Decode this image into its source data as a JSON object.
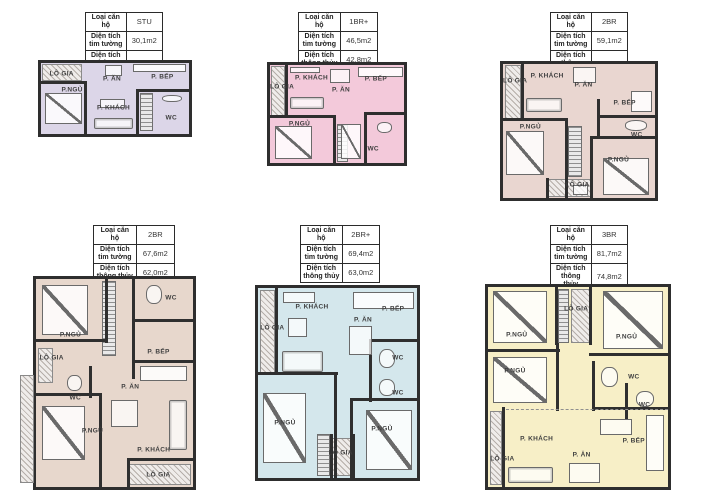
{
  "table_labels": {
    "type": "Loại căn hộ",
    "gross": "Diện tích tim tường",
    "net": "Diện tích thông thủy"
  },
  "units": [
    {
      "type": "STU",
      "gross": "30,1m2",
      "net": "26,3m2",
      "fill": "#dcd6e8",
      "table_box": {
        "left": 85,
        "top": 12,
        "width": 78
      },
      "plan_box": {
        "left": 38,
        "top": 60,
        "width": 154,
        "height": 77
      },
      "labels": [
        {
          "t": "LÔ GIA",
          "x": 14,
          "y": 15
        },
        {
          "t": "P. ĂN",
          "x": 48,
          "y": 22
        },
        {
          "t": "P. BẾP",
          "x": 82,
          "y": 20
        },
        {
          "t": "P.NGỦ",
          "x": 21,
          "y": 38
        },
        {
          "t": "P. KHÁCH",
          "x": 49,
          "y": 64
        },
        {
          "t": "WC",
          "x": 88,
          "y": 77
        }
      ],
      "hatches": [
        {
          "kind": "balcony",
          "x": 1,
          "y": 1,
          "w": 27,
          "h": 24
        },
        {
          "kind": "stairs",
          "x": 67,
          "y": 42,
          "w": 9,
          "h": 54
        }
      ],
      "walls": [
        {
          "x": 0,
          "y": 26,
          "w": 31,
          "h": 4
        },
        {
          "x": 29,
          "y": 26,
          "w": 2.5,
          "h": 74
        },
        {
          "x": 64,
          "y": 36,
          "w": 2.5,
          "h": 64
        },
        {
          "x": 64,
          "y": 36,
          "w": 36,
          "h": 4
        }
      ],
      "items": [
        {
          "kind": "bed",
          "x": 3,
          "y": 42,
          "w": 25,
          "h": 44
        },
        {
          "kind": "sofa",
          "x": 36,
          "y": 78,
          "w": 26,
          "h": 15
        },
        {
          "kind": "table",
          "x": 40,
          "y": 50,
          "w": 17,
          "h": 14
        },
        {
          "kind": "table",
          "x": 43,
          "y": 3,
          "w": 12,
          "h": 15
        },
        {
          "kind": "counter",
          "x": 62,
          "y": 2,
          "w": 36,
          "h": 11
        },
        {
          "kind": "fixture",
          "x": 82,
          "y": 45,
          "w": 13,
          "h": 10
        }
      ]
    },
    {
      "type": "1BR+",
      "gross": "46,5m2",
      "net": "42,8m2",
      "fill": "#f3c9da",
      "table_box": {
        "left": 298,
        "top": 12,
        "width": 80
      },
      "plan_box": {
        "left": 267,
        "top": 62,
        "width": 140,
        "height": 104
      },
      "labels": [
        {
          "t": "P. KHÁCH",
          "x": 31,
          "y": 13
        },
        {
          "t": "P. ĂN",
          "x": 53,
          "y": 25
        },
        {
          "t": "P. BẾP",
          "x": 79,
          "y": 14
        },
        {
          "t": "LÔ GIA",
          "x": 9,
          "y": 22
        },
        {
          "t": "P.NGỦ",
          "x": 22,
          "y": 60
        },
        {
          "t": "WC",
          "x": 77,
          "y": 86
        }
      ],
      "hatches": [
        {
          "kind": "balcony",
          "x": 1,
          "y": 1,
          "w": 10,
          "h": 52
        },
        {
          "kind": "stairs",
          "x": 50,
          "y": 60,
          "w": 8,
          "h": 39
        }
      ],
      "walls": [
        {
          "x": 11,
          "y": 0,
          "w": 2.5,
          "h": 54
        },
        {
          "x": 0,
          "y": 51,
          "w": 49,
          "h": 4
        },
        {
          "x": 47,
          "y": 51,
          "w": 2.5,
          "h": 49
        },
        {
          "x": 70,
          "y": 48,
          "w": 2.5,
          "h": 52
        },
        {
          "x": 70,
          "y": 48,
          "w": 30,
          "h": 4
        }
      ],
      "items": [
        {
          "kind": "table",
          "x": 15,
          "y": 2,
          "w": 22,
          "h": 6
        },
        {
          "kind": "sofa",
          "x": 15,
          "y": 33,
          "w": 25,
          "h": 12
        },
        {
          "kind": "table",
          "x": 45,
          "y": 4,
          "w": 15,
          "h": 14
        },
        {
          "kind": "counter",
          "x": 66,
          "y": 2,
          "w": 33,
          "h": 10
        },
        {
          "kind": "bed",
          "x": 4,
          "y": 62,
          "w": 27,
          "h": 34
        },
        {
          "kind": "bed",
          "x": 53,
          "y": 60,
          "w": 15,
          "h": 36
        },
        {
          "kind": "fixture",
          "x": 80,
          "y": 58,
          "w": 11,
          "h": 11
        }
      ]
    },
    {
      "type": "2BR",
      "gross": "59,1m2",
      "net": "54,2m2",
      "fill": "#e9d6d0",
      "table_box": {
        "left": 550,
        "top": 12,
        "width": 78
      },
      "plan_box": {
        "left": 500,
        "top": 61,
        "width": 158,
        "height": 140
      },
      "labels": [
        {
          "t": "LÔ GIA",
          "x": 8,
          "y": 13
        },
        {
          "t": "P. KHÁCH",
          "x": 29,
          "y": 9
        },
        {
          "t": "P. ĂN",
          "x": 53,
          "y": 16
        },
        {
          "t": "P. BẾP",
          "x": 80,
          "y": 29
        },
        {
          "t": "P.NGỦ",
          "x": 18,
          "y": 47
        },
        {
          "t": "WC",
          "x": 88,
          "y": 53
        },
        {
          "t": "P.NGỦ",
          "x": 76,
          "y": 72
        },
        {
          "t": "LÔ GIA",
          "x": 49,
          "y": 90
        }
      ],
      "hatches": [
        {
          "kind": "balcony",
          "x": 1,
          "y": 1,
          "w": 11,
          "h": 40
        },
        {
          "kind": "stairs",
          "x": 43,
          "y": 46,
          "w": 9,
          "h": 38
        },
        {
          "kind": "balcony",
          "x": 29,
          "y": 86,
          "w": 29,
          "h": 13
        }
      ],
      "walls": [
        {
          "x": 12,
          "y": 0,
          "w": 2.5,
          "h": 42
        },
        {
          "x": 0,
          "y": 40,
          "w": 43,
          "h": 4
        },
        {
          "x": 41,
          "y": 40,
          "w": 2.5,
          "h": 60
        },
        {
          "x": 57,
          "y": 54,
          "w": 43,
          "h": 4
        },
        {
          "x": 57,
          "y": 54,
          "w": 2.5,
          "h": 46
        },
        {
          "x": 62,
          "y": 26,
          "w": 2.5,
          "h": 30
        },
        {
          "x": 62,
          "y": 38,
          "w": 38,
          "h": 3
        },
        {
          "x": 28,
          "y": 85,
          "w": 2.5,
          "h": 15
        },
        {
          "x": 57,
          "y": 85,
          "w": 2.5,
          "h": 15
        }
      ],
      "items": [
        {
          "kind": "sofa",
          "x": 15,
          "y": 25,
          "w": 24,
          "h": 11
        },
        {
          "kind": "table",
          "x": 46,
          "y": 2,
          "w": 15,
          "h": 12
        },
        {
          "kind": "counter",
          "x": 84,
          "y": 20,
          "w": 14,
          "h": 16
        },
        {
          "kind": "bed",
          "x": 2,
          "y": 50,
          "w": 25,
          "h": 33
        },
        {
          "kind": "bed",
          "x": 66,
          "y": 70,
          "w": 30,
          "h": 28
        },
        {
          "kind": "fixture",
          "x": 80,
          "y": 42,
          "w": 15,
          "h": 8
        },
        {
          "kind": "table",
          "x": 46,
          "y": 90,
          "w": 10,
          "h": 8
        }
      ]
    },
    {
      "type": "2BR",
      "gross": "67,6m2",
      "net": "62,0m2",
      "fill": "#e7d7cc",
      "table_box": {
        "left": 93,
        "top": 225,
        "width": 82
      },
      "plan_box": {
        "left": 33,
        "top": 276,
        "width": 163,
        "height": 214
      },
      "labels": [
        {
          "t": "P.NGỦ",
          "x": 22,
          "y": 27
        },
        {
          "t": "WC",
          "x": 86,
          "y": 9
        },
        {
          "t": "P. BẾP",
          "x": 78,
          "y": 35
        },
        {
          "t": "LÔ GIA",
          "x": 10,
          "y": 38
        },
        {
          "t": "WC",
          "x": 25,
          "y": 57
        },
        {
          "t": "P. ĂN",
          "x": 60,
          "y": 52
        },
        {
          "t": "P.NGỦ",
          "x": 36,
          "y": 73
        },
        {
          "t": "P. KHÁCH",
          "x": 75,
          "y": 82
        },
        {
          "t": "LÔ GIA",
          "x": 78,
          "y": 94
        }
      ],
      "hatches": [
        {
          "kind": "stairs",
          "x": 42,
          "y": 1,
          "w": 9,
          "h": 36
        },
        {
          "kind": "balcony",
          "x": 1,
          "y": 33,
          "w": 10,
          "h": 17
        },
        {
          "kind": "balcony",
          "x": 59,
          "y": 89,
          "w": 40,
          "h": 10
        },
        {
          "kind": "balcony",
          "x": -10,
          "y": 46,
          "w": 9,
          "h": 52
        }
      ],
      "walls": [
        {
          "x": 44,
          "y": 0,
          "w": 2.5,
          "h": 31
        },
        {
          "x": 0,
          "y": 29,
          "w": 46,
          "h": 4
        },
        {
          "x": 61,
          "y": 0,
          "w": 2.5,
          "h": 48
        },
        {
          "x": 61,
          "y": 19,
          "w": 39,
          "h": 3
        },
        {
          "x": 61,
          "y": 39,
          "w": 39,
          "h": 3
        },
        {
          "x": 0,
          "y": 55,
          "w": 42,
          "h": 4
        },
        {
          "x": 40,
          "y": 55,
          "w": 2.5,
          "h": 45
        },
        {
          "x": 34,
          "y": 42,
          "w": 2.5,
          "h": 15
        },
        {
          "x": 58,
          "y": 86,
          "w": 42,
          "h": 3
        },
        {
          "x": 58,
          "y": 86,
          "w": 2.5,
          "h": 14
        }
      ],
      "items": [
        {
          "kind": "bed",
          "x": 4,
          "y": 3,
          "w": 29,
          "h": 24
        },
        {
          "kind": "fixture",
          "x": 70,
          "y": 3,
          "w": 10,
          "h": 9
        },
        {
          "kind": "counter",
          "x": 66,
          "y": 42,
          "w": 30,
          "h": 7
        },
        {
          "kind": "table",
          "x": 48,
          "y": 58,
          "w": 17,
          "h": 13
        },
        {
          "kind": "bed",
          "x": 4,
          "y": 61,
          "w": 27,
          "h": 26
        },
        {
          "kind": "sofa",
          "x": 85,
          "y": 58,
          "w": 11,
          "h": 24
        },
        {
          "kind": "fixture",
          "x": 20,
          "y": 46,
          "w": 9,
          "h": 8
        }
      ]
    },
    {
      "type": "2BR+",
      "gross": "69,4m2",
      "net": "63,0m2",
      "fill": "#d4e7ec",
      "table_box": {
        "left": 300,
        "top": 225,
        "width": 80
      },
      "plan_box": {
        "left": 255,
        "top": 285,
        "width": 165,
        "height": 196
      },
      "labels": [
        {
          "t": "P. KHÁCH",
          "x": 34,
          "y": 10
        },
        {
          "t": "P. BẾP",
          "x": 85,
          "y": 11
        },
        {
          "t": "P. ĂN",
          "x": 66,
          "y": 17
        },
        {
          "t": "LÔ GIA",
          "x": 9,
          "y": 21
        },
        {
          "t": "WC",
          "x": 88,
          "y": 37
        },
        {
          "t": "WC",
          "x": 88,
          "y": 55
        },
        {
          "t": "P.NGỦ",
          "x": 17,
          "y": 71
        },
        {
          "t": "P.NGỦ",
          "x": 78,
          "y": 74
        },
        {
          "t": "LÔ GIA",
          "x": 52,
          "y": 87
        }
      ],
      "hatches": [
        {
          "kind": "balcony",
          "x": 1,
          "y": 1,
          "w": 10,
          "h": 45
        },
        {
          "kind": "stairs",
          "x": 37,
          "y": 77,
          "w": 8,
          "h": 22
        },
        {
          "kind": "balcony",
          "x": 46,
          "y": 79,
          "w": 13,
          "h": 20
        }
      ],
      "walls": [
        {
          "x": 11,
          "y": 0,
          "w": 2.5,
          "h": 46
        },
        {
          "x": 0,
          "y": 44,
          "w": 50,
          "h": 4
        },
        {
          "x": 48,
          "y": 44,
          "w": 2.5,
          "h": 56
        },
        {
          "x": 70,
          "y": 27,
          "w": 30,
          "h": 3
        },
        {
          "x": 70,
          "y": 27,
          "w": 2.5,
          "h": 33
        },
        {
          "x": 58,
          "y": 58,
          "w": 42,
          "h": 4
        },
        {
          "x": 58,
          "y": 58,
          "w": 2.5,
          "h": 42
        },
        {
          "x": 45,
          "y": 77,
          "w": 2,
          "h": 23
        },
        {
          "x": 59,
          "y": 77,
          "w": 2,
          "h": 23
        }
      ],
      "items": [
        {
          "kind": "table",
          "x": 16,
          "y": 2,
          "w": 20,
          "h": 6
        },
        {
          "kind": "sofa",
          "x": 15,
          "y": 33,
          "w": 26,
          "h": 11
        },
        {
          "kind": "table",
          "x": 19,
          "y": 16,
          "w": 12,
          "h": 10
        },
        {
          "kind": "table",
          "x": 57,
          "y": 20,
          "w": 15,
          "h": 15
        },
        {
          "kind": "counter",
          "x": 60,
          "y": 2,
          "w": 38,
          "h": 9
        },
        {
          "kind": "bed",
          "x": 3,
          "y": 55,
          "w": 27,
          "h": 37
        },
        {
          "kind": "bed",
          "x": 68,
          "y": 64,
          "w": 29,
          "h": 32
        },
        {
          "kind": "fixture",
          "x": 76,
          "y": 32,
          "w": 10,
          "h": 10
        },
        {
          "kind": "fixture",
          "x": 76,
          "y": 48,
          "w": 10,
          "h": 9
        }
      ]
    },
    {
      "type": "3BR",
      "gross": "81,7m2",
      "net": "74,8m2",
      "fill": "#f7efc7",
      "table_box": {
        "left": 550,
        "top": 225,
        "width": 78
      },
      "plan_box": {
        "left": 485,
        "top": 284,
        "width": 186,
        "height": 206
      },
      "labels": [
        {
          "t": "P.NGỦ",
          "x": 16,
          "y": 24
        },
        {
          "t": "LÔ GIA",
          "x": 49,
          "y": 11
        },
        {
          "t": "P.NGỦ",
          "x": 77,
          "y": 25
        },
        {
          "t": "P.NGỦ",
          "x": 15,
          "y": 42
        },
        {
          "t": "WC",
          "x": 81,
          "y": 45
        },
        {
          "t": "WC",
          "x": 87,
          "y": 59
        },
        {
          "t": "P. KHÁCH",
          "x": 27,
          "y": 76
        },
        {
          "t": "P. ĂN",
          "x": 52,
          "y": 84
        },
        {
          "t": "P. BẾP",
          "x": 81,
          "y": 77
        },
        {
          "t": "LÔ GIA",
          "x": 8,
          "y": 86
        }
      ],
      "hatches": [
        {
          "kind": "stairs",
          "x": 39,
          "y": 1,
          "w": 6,
          "h": 27
        },
        {
          "kind": "balcony",
          "x": 46,
          "y": 1,
          "w": 11,
          "h": 27
        },
        {
          "kind": "balcony",
          "x": 1,
          "y": 62,
          "w": 7,
          "h": 37
        }
      ],
      "walls": [
        {
          "x": 37,
          "y": 0,
          "w": 2.5,
          "h": 29
        },
        {
          "x": 56,
          "y": 0,
          "w": 2.5,
          "h": 29
        },
        {
          "x": 0,
          "y": 31,
          "w": 40,
          "h": 3
        },
        {
          "x": 38,
          "y": 28,
          "w": 2.5,
          "h": 34
        },
        {
          "x": 56,
          "y": 33,
          "w": 44,
          "h": 4
        },
        {
          "x": 58,
          "y": 37,
          "w": 2.5,
          "h": 25
        },
        {
          "x": 76,
          "y": 48,
          "w": 2.5,
          "h": 18
        },
        {
          "x": 58,
          "y": 60,
          "w": 42,
          "h": 3
        },
        {
          "x": 8,
          "y": 60,
          "w": 2.5,
          "h": 40
        },
        {
          "x": 10,
          "y": 61,
          "w": 90,
          "h": 0,
          "dashed": true
        }
      ],
      "items": [
        {
          "kind": "bed",
          "x": 3,
          "y": 2,
          "w": 30,
          "h": 26
        },
        {
          "kind": "bed",
          "x": 64,
          "y": 2,
          "w": 33,
          "h": 29
        },
        {
          "kind": "bed",
          "x": 3,
          "y": 35,
          "w": 30,
          "h": 23
        },
        {
          "kind": "sofa",
          "x": 11,
          "y": 90,
          "w": 25,
          "h": 8
        },
        {
          "kind": "table",
          "x": 45,
          "y": 88,
          "w": 17,
          "h": 10
        },
        {
          "kind": "counter",
          "x": 88,
          "y": 64,
          "w": 10,
          "h": 28
        },
        {
          "kind": "table",
          "x": 62,
          "y": 66,
          "w": 18,
          "h": 8
        },
        {
          "kind": "fixture",
          "x": 63,
          "y": 40,
          "w": 9,
          "h": 10
        },
        {
          "kind": "fixture",
          "x": 82,
          "y": 52,
          "w": 10,
          "h": 8
        }
      ]
    }
  ]
}
